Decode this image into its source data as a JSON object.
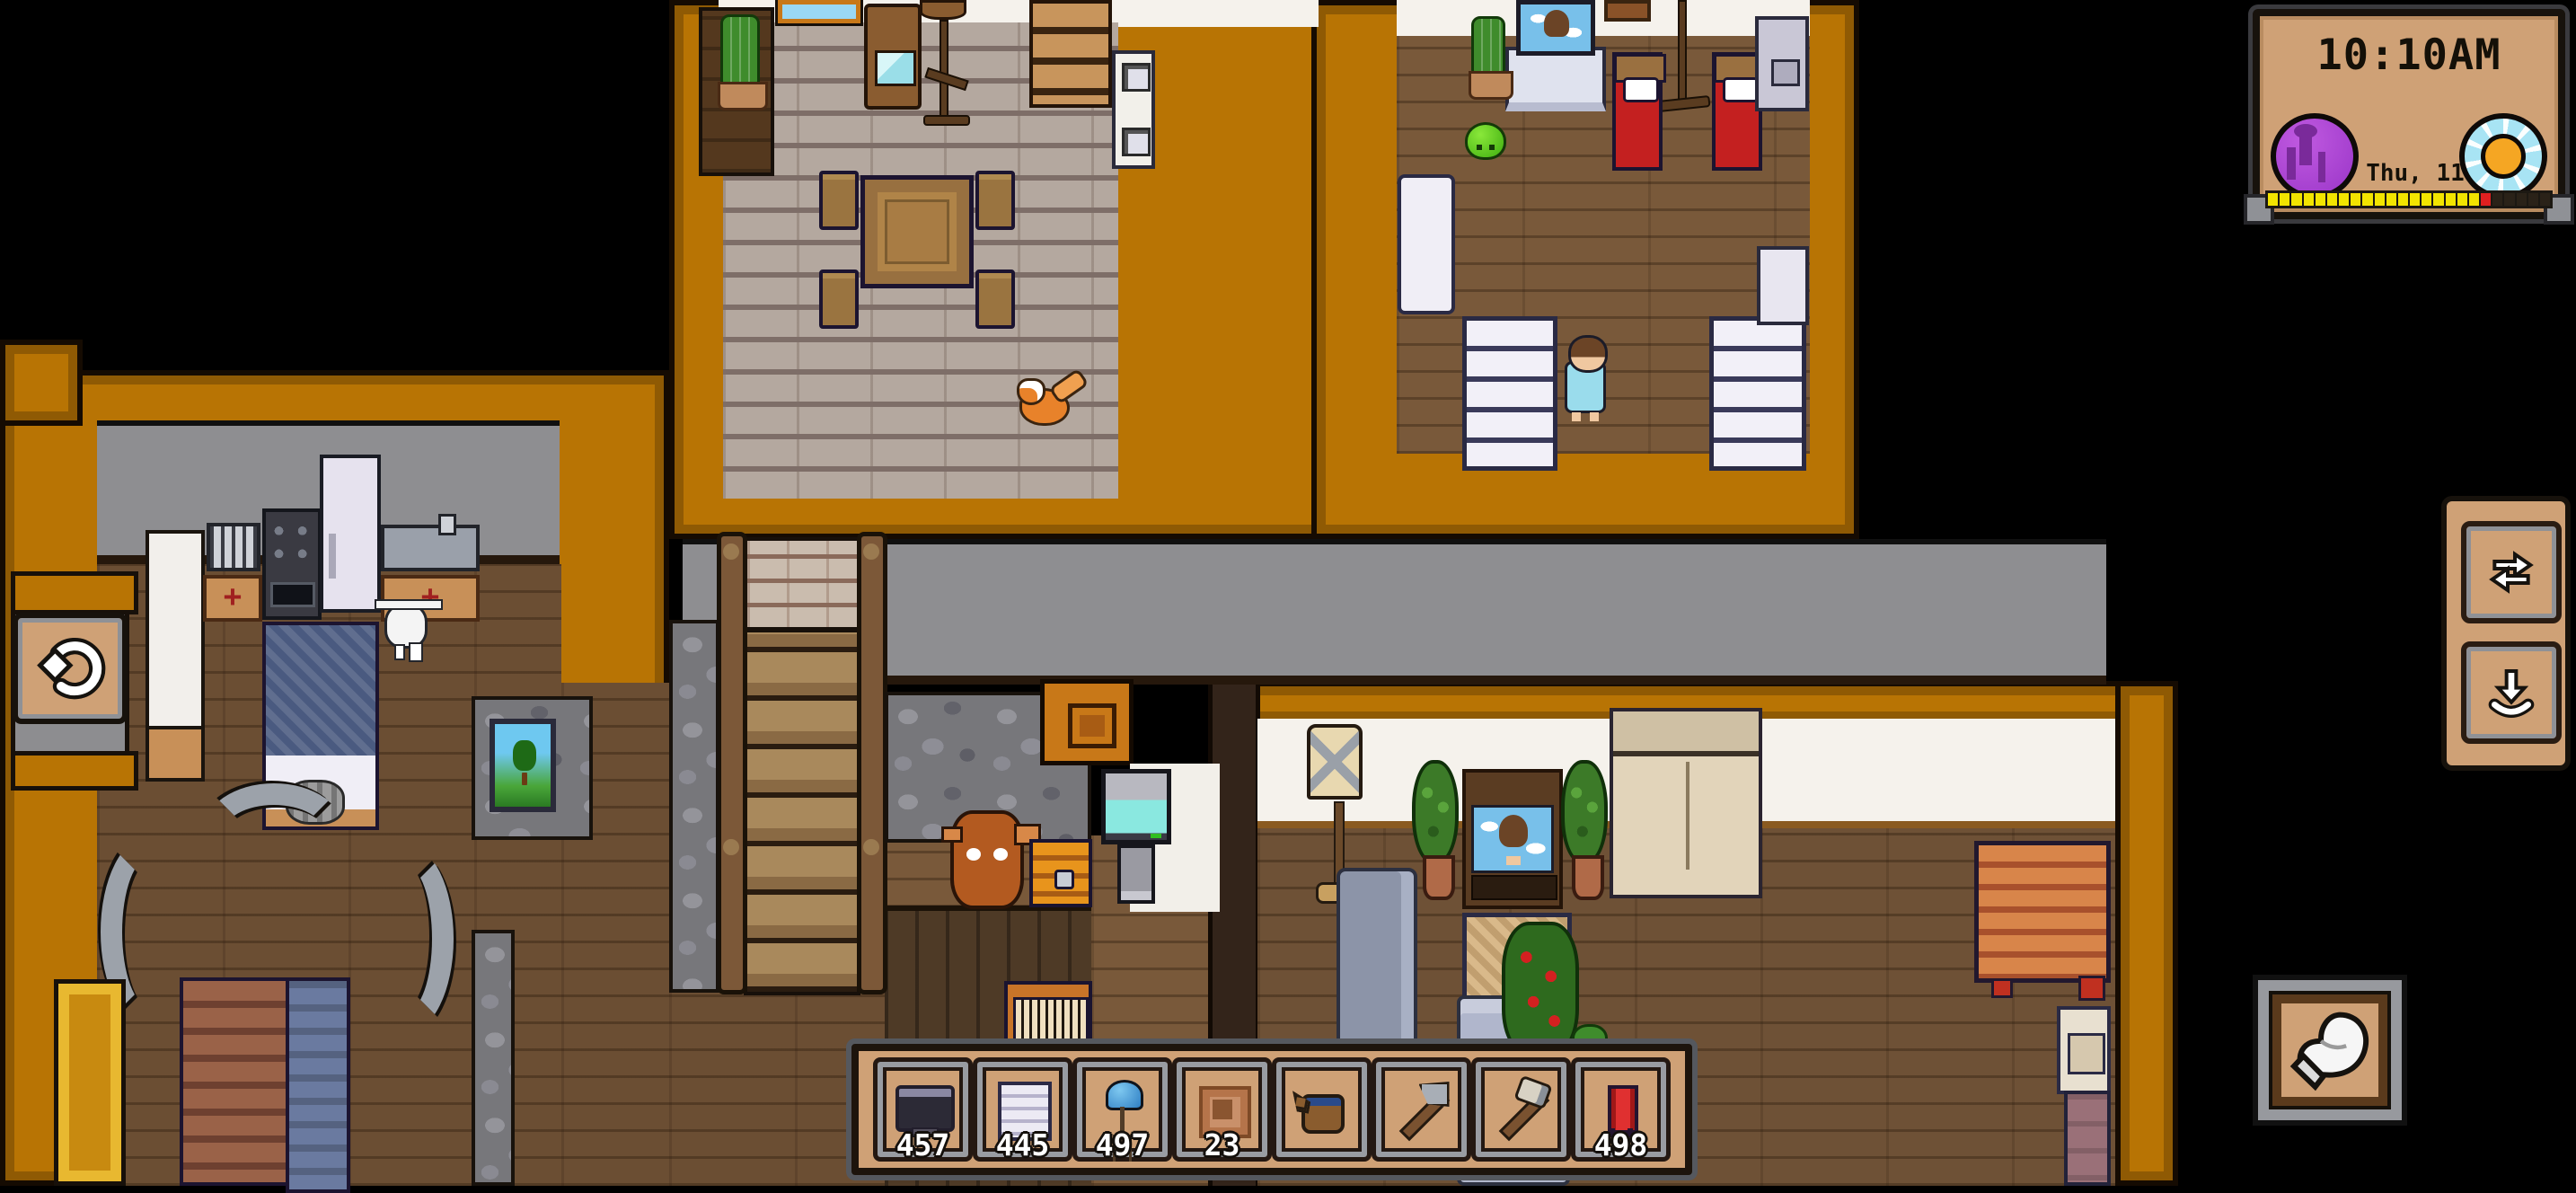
{
  "hud": {
    "clock": {
      "time": "10:10AM",
      "date": "Thu, 11",
      "left_icon": "moon-orb-icon",
      "right_icon": "sun-orb-icon",
      "progress_segments": [
        "on",
        "on",
        "on",
        "on",
        "on",
        "on",
        "on",
        "on",
        "on",
        "on",
        "on",
        "on",
        "on",
        "on",
        "on",
        "on",
        "on",
        "on",
        "now",
        "off",
        "off",
        "off",
        "off",
        "off"
      ]
    },
    "side_panel": {
      "buttons": [
        {
          "name": "swap",
          "icon": "swap-arrows-icon"
        },
        {
          "name": "pickup",
          "icon": "store-down-arrow-icon"
        }
      ]
    },
    "undo_button": {
      "icon": "undo-arrow-icon"
    },
    "hand_button": {
      "icon": "glove-icon"
    }
  },
  "hotbar": {
    "slots": [
      {
        "item": "tv",
        "qty": "457"
      },
      {
        "item": "white-shelf",
        "qty": "445"
      },
      {
        "item": "blue-lamp",
        "qty": "497"
      },
      {
        "item": "picture-frame",
        "qty": "23"
      },
      {
        "item": "watering-can",
        "qty": ""
      },
      {
        "item": "axe",
        "qty": ""
      },
      {
        "item": "hammer",
        "qty": ""
      },
      {
        "item": "red-chair",
        "qty": "498"
      }
    ]
  },
  "scene": {
    "rooms": [
      "dining-room",
      "bedroom",
      "kitchen",
      "storage-room",
      "living-room"
    ],
    "entities": [
      "fox",
      "toddler",
      "slime-pet",
      "robot-drone",
      "calf-pet",
      "cat"
    ],
    "colors": {
      "wall_orange": "#b87404",
      "panel_tan": "#cfa176",
      "progress_yellow": "#f2e400",
      "progress_red": "#e02020",
      "bed_red": "#c42020"
    }
  }
}
